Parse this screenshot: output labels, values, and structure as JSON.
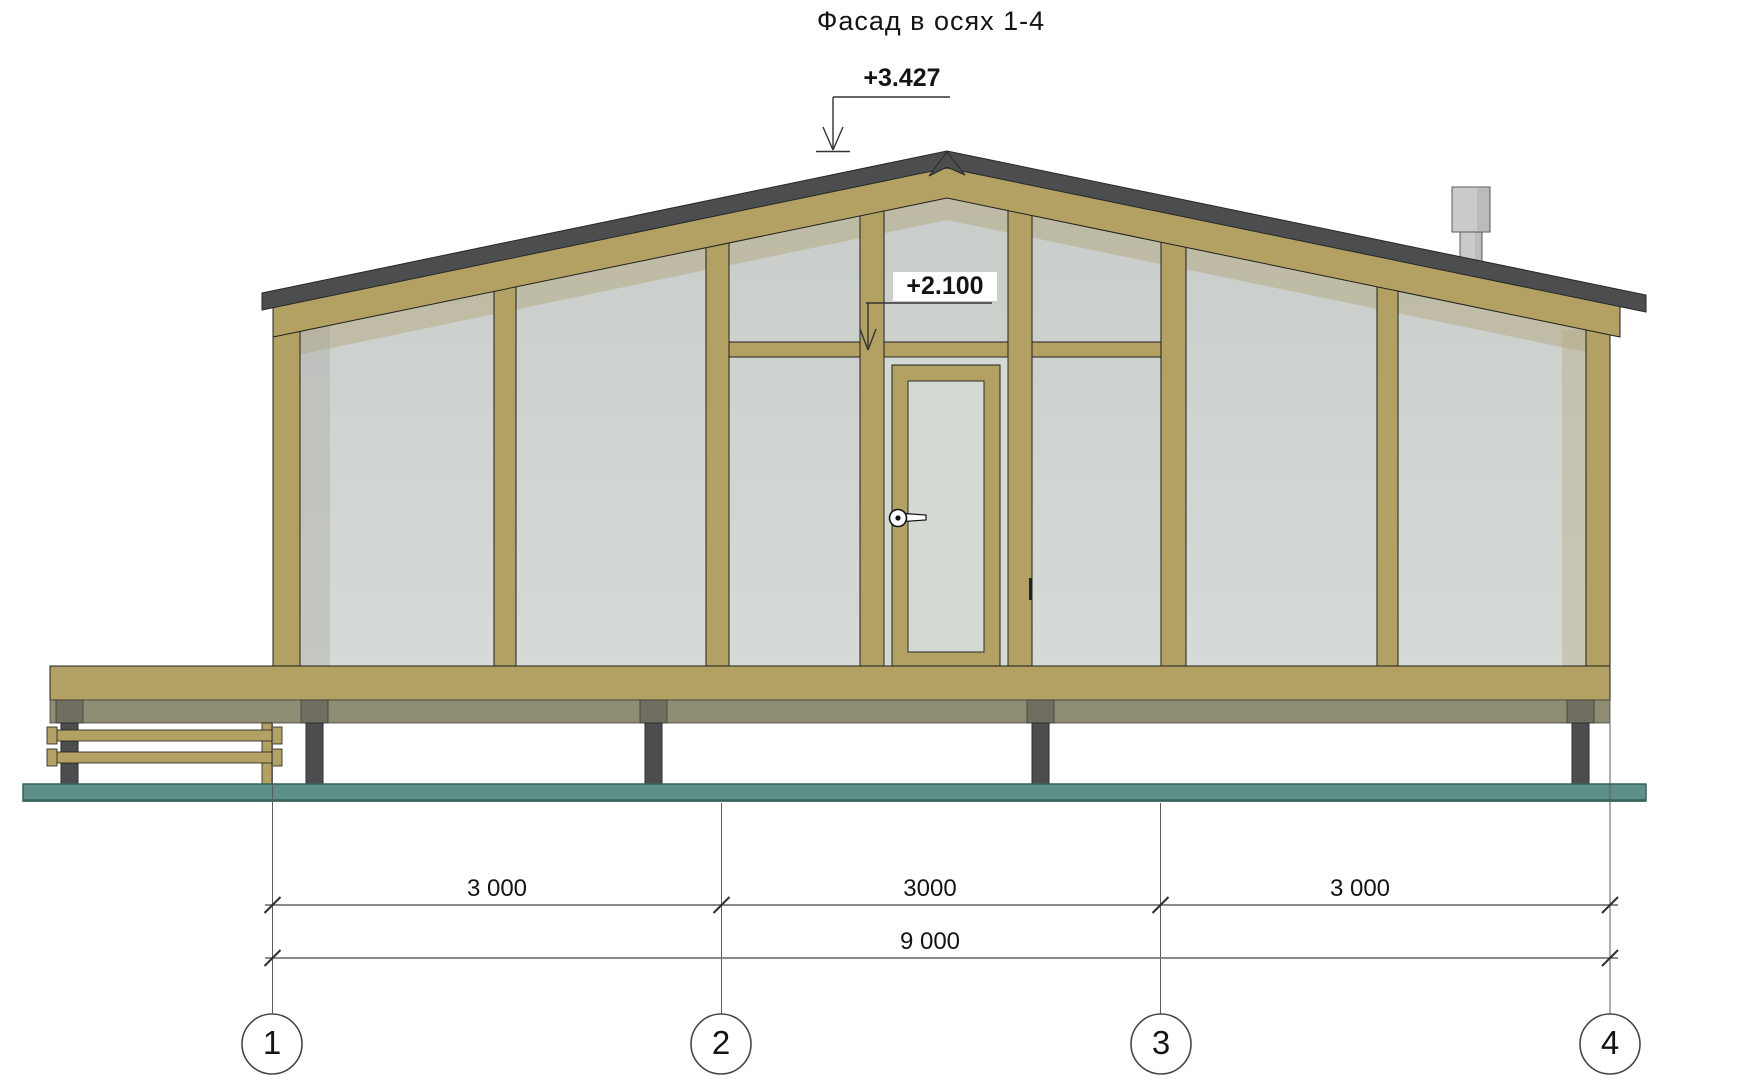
{
  "drawing": {
    "title": "Фасад в осях 1-4",
    "elevation_marks": {
      "ridge": "+3.427",
      "door_top": "+2.100"
    },
    "dimensions": {
      "segments": [
        "3 000",
        "3000",
        "3 000"
      ],
      "total": "9 000"
    },
    "axes": [
      "1",
      "2",
      "3",
      "4"
    ]
  },
  "colors": {
    "wood": "#b2a162",
    "wood_dark": "#9c8c54",
    "roof_dark": "#4b4d4f",
    "glass_top": "#c8cdca",
    "glass_bottom": "#d7dbd7",
    "door_glass": "#d5d9d4",
    "shadow_beige": "#b3a77f",
    "shadow_gray": "#a3a39c",
    "rim": "#8f8c74",
    "pile_cap": "#6f6e61",
    "pile": "#4b4d4f",
    "ground": "#5d9089",
    "ground_dark": "#35645c",
    "chimney": "#cbcbcb",
    "dim_line": "#7a7a7a",
    "text": "#141414",
    "outline": "#1f1f1f"
  }
}
